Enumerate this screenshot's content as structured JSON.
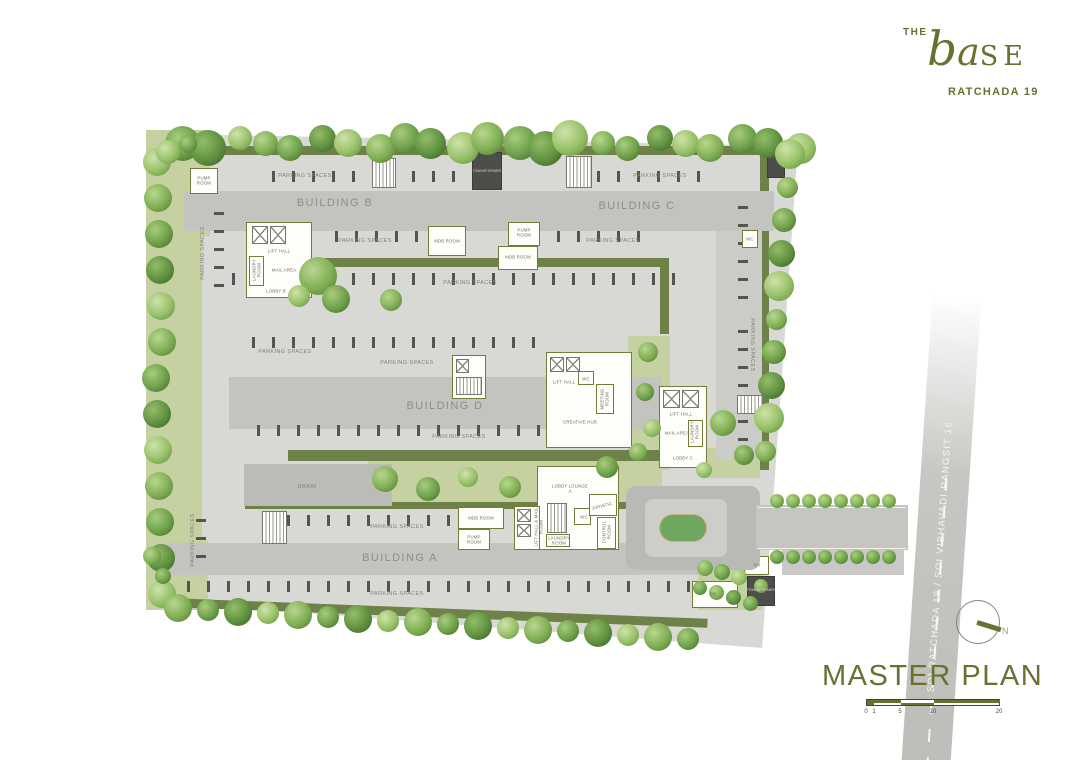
{
  "brand": {
    "the": "THE",
    "name_b": "b",
    "name_a": "a",
    "name_se": "SE",
    "subtitle": "RATCHADA 19"
  },
  "plan": {
    "buildings": {
      "a": "BUILDING A",
      "b": "BUILDING B",
      "c": "BUILDING C",
      "d": "BUILDING D"
    },
    "labels": {
      "parking": "PARKING SPACES",
      "pump_room": "PUMP ROOM",
      "mdb_room": "MDB ROOM",
      "lift_hall": "LIFT HALL",
      "mail_area": "MAIL AREA",
      "laundry_room": "LAUNDRY ROOM",
      "lobby_b": "LOBBY B",
      "lobby_c": "LOBBY C",
      "lobby_lounge_a": "LOBBY LOUNGE A",
      "creative_hub": "CREATIVE HUB",
      "meeting_room": "MEETING ROOM",
      "juristic": "JURISTIC",
      "wc": "WC",
      "control_room": "CONTROL ROOM",
      "lift_hall_mail_room": "LIFT HALL & MAIL ROOM",
      "transformer": "TRANSFORMER",
      "drain": "DRAIN",
      "gh": "GH",
      "gr": "GR"
    },
    "road_label": "SOI RATCHADA 19 / SOI VIBHAVADI RANGSIT 16"
  },
  "footer": {
    "title": "MASTER PLAN",
    "compass_n": "N",
    "scale_ticks": [
      "0",
      "1",
      "5",
      "10",
      "20"
    ]
  },
  "colors": {
    "brand_olive": "#6b7030",
    "ground": "#d8d8d4",
    "building": "#c3c3bf",
    "lawn": "#c6d1a2",
    "hedge": "#6d8148",
    "island_green": "#6fa660",
    "road": "#c6c6c2"
  }
}
